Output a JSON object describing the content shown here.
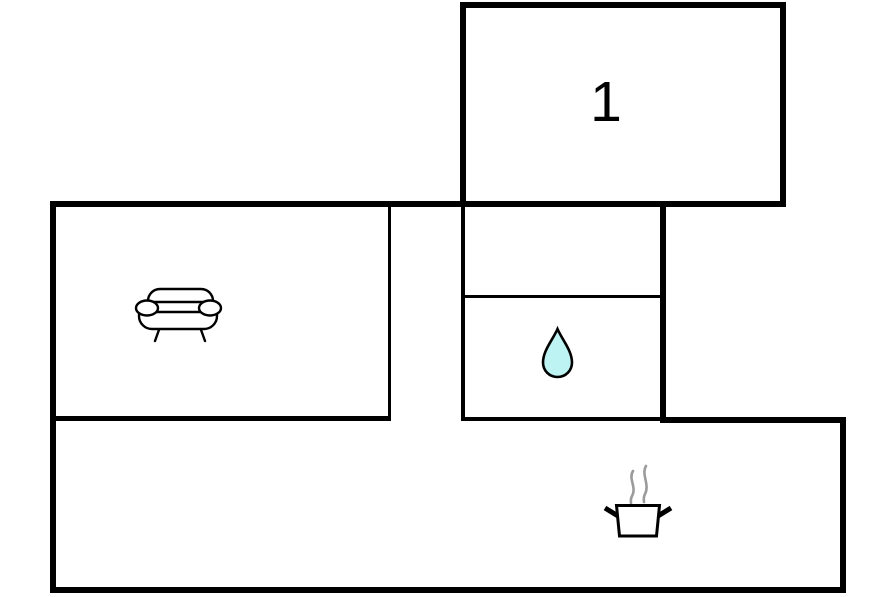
{
  "floorplan": {
    "wall_color": "#000000",
    "background_color": "#ffffff",
    "rooms": {
      "room1": {
        "label": "1"
      },
      "living_room": {
        "icon": "sofa-icon"
      },
      "bathroom": {
        "icon": "water-drop-icon"
      },
      "kitchen": {
        "icon": "cooking-pot-icon"
      }
    },
    "icon_colors": {
      "outline": "#000000",
      "water_drop_fill": "#bdf3f2",
      "steam_gray": "#9b9b9b"
    }
  }
}
